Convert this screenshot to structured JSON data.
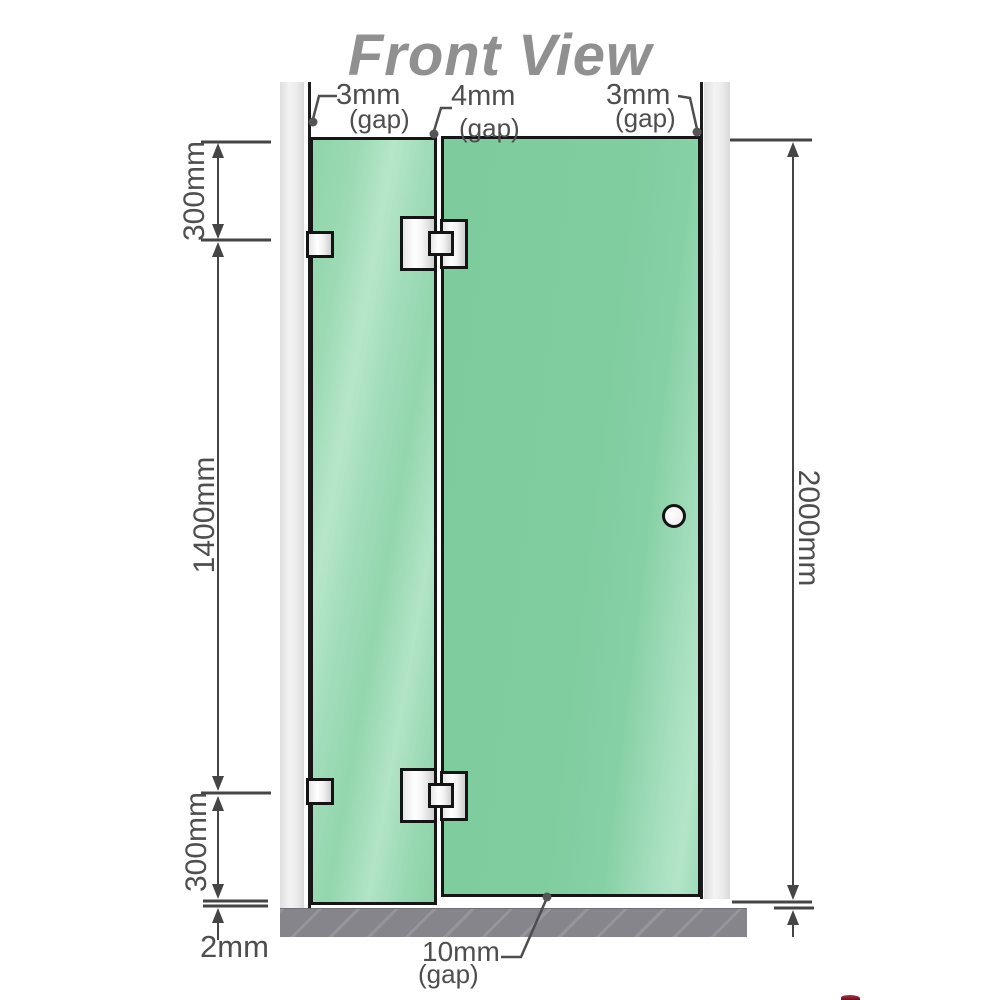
{
  "title": "Front View",
  "annotations": {
    "gap_top_left": {
      "value": "3mm",
      "qualifier": "(gap)"
    },
    "gap_top_middle": {
      "value": "4mm",
      "qualifier": "(gap)"
    },
    "gap_top_right": {
      "value": "3mm",
      "qualifier": "(gap)"
    },
    "left_segment_top": "300mm",
    "left_segment_middle": "1400mm",
    "left_segment_bottom": "300mm",
    "right_overall_height": "2000mm",
    "bottom_floor_gap": "2mm",
    "bottom_door_gap": {
      "value": "10mm",
      "qualifier": "(gap)"
    }
  },
  "colors": {
    "glass_green": "#7ecc9e",
    "glass_highlight": "#b7e6c9",
    "wall_channel_gray": "#ececec",
    "floor_gray": "#85858b",
    "dimension_line": "#454545",
    "label_text": "#4e4e4e",
    "title_text": "#909090",
    "hardware_outline": "#141414"
  }
}
